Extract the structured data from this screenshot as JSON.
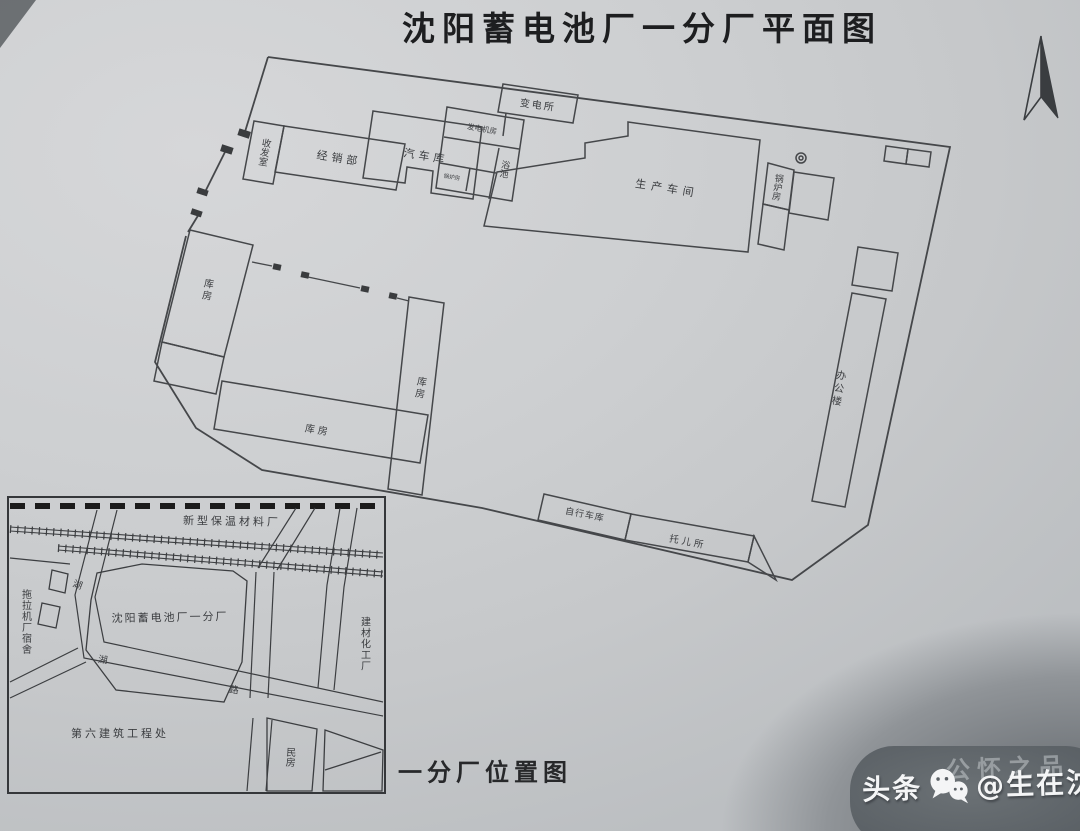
{
  "page": {
    "title": "沈阳蓄电池厂一分厂平面图",
    "inset_caption": "一分厂位置图"
  },
  "plan": {
    "buildings": {
      "shoufashi": "收发室",
      "jingxiaobu": "经销部",
      "qicheku": "汽车库",
      "fadianjifang": "发电机房",
      "yuchi": "浴池",
      "xiaoguolufang": "锅炉房",
      "biandiansuo": "变电所",
      "shengchanchejian": "生产车间",
      "guolufang": "锅炉房",
      "bangonglou": "办公楼",
      "kufang_left": "库房",
      "kufang_mid": "库房",
      "kufang_bottom": "库房",
      "zixingcheku": "自行车库",
      "tuoersuo": "托儿所"
    }
  },
  "inset": {
    "labels": {
      "xinxing": "新型保温材料厂",
      "tuolaji": "拖拉机厂宿舍",
      "plant": "沈阳蓄电池厂一分厂",
      "jiancai": "建材化工厂",
      "diliu": "第六建筑工程处",
      "minfang": "民房",
      "road_hu_upper": "湖",
      "road_hu_bend": "湖",
      "road_lu": "路"
    }
  },
  "watermark": {
    "platform": "头条",
    "handle": "@生在沈阳",
    "faint_text": "公怀之品"
  },
  "colors": {
    "paper": "#cdcfd1",
    "ink": "#45474a",
    "title_ink": "#1d1e20",
    "watermark_bg": "#5a6065",
    "watermark_text": "#f4f5f6"
  }
}
